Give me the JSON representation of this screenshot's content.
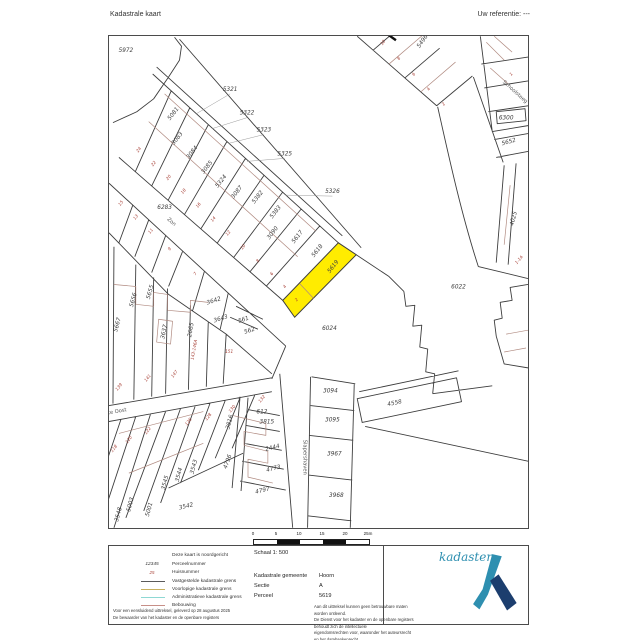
{
  "header": {
    "title": "Kadastrale kaart",
    "reference": "Uw referentie: ---"
  },
  "map": {
    "highlight_color": "#ffec00",
    "boundary_color": "#3d3d3d",
    "building_color": "#b08a80",
    "parcel_labels": [
      {
        "t": "5972",
        "x": 17,
        "y": 16,
        "s": 6.2
      },
      {
        "t": "5321",
        "x": 122,
        "y": 55,
        "s": 6
      },
      {
        "t": "5322",
        "x": 139,
        "y": 79,
        "s": 6
      },
      {
        "t": "5323",
        "x": 156,
        "y": 96,
        "s": 6
      },
      {
        "t": "5325",
        "x": 177,
        "y": 120,
        "s": 6
      },
      {
        "t": "5326",
        "x": 225,
        "y": 158,
        "s": 6
      },
      {
        "t": "6283",
        "x": 56,
        "y": 174,
        "s": 6
      },
      {
        "t": "5081",
        "x": 66,
        "y": 79,
        "r": -52
      },
      {
        "t": "3083",
        "x": 70,
        "y": 104,
        "r": -52
      },
      {
        "t": "3084",
        "x": 85,
        "y": 118,
        "r": -52
      },
      {
        "t": "3085",
        "x": 100,
        "y": 133,
        "r": -52
      },
      {
        "t": "5324",
        "x": 114,
        "y": 147,
        "r": -52
      },
      {
        "t": "3087",
        "x": 130,
        "y": 158,
        "r": -52
      },
      {
        "t": "5382",
        "x": 151,
        "y": 163,
        "r": -52
      },
      {
        "t": "5383",
        "x": 169,
        "y": 178,
        "r": -52
      },
      {
        "t": "3090",
        "x": 166,
        "y": 199,
        "r": -52
      },
      {
        "t": "5617",
        "x": 191,
        "y": 203,
        "r": -52
      },
      {
        "t": "5618",
        "x": 211,
        "y": 217,
        "r": -52
      },
      {
        "t": "5619",
        "x": 227,
        "y": 233,
        "r": -52
      },
      {
        "t": "5656",
        "x": 26,
        "y": 266,
        "r": -75
      },
      {
        "t": "5655",
        "x": 43,
        "y": 258,
        "r": -75
      },
      {
        "t": "5667",
        "x": 10,
        "y": 291,
        "r": -75
      },
      {
        "t": "3637",
        "x": 57,
        "y": 298,
        "r": -78
      },
      {
        "t": "2665",
        "x": 84,
        "y": 296,
        "r": -80
      },
      {
        "t": "3642",
        "x": 106,
        "y": 268,
        "r": -18
      },
      {
        "t": "3643",
        "x": 113,
        "y": 286,
        "r": -18
      },
      {
        "t": "561",
        "x": 136,
        "y": 287,
        "r": -18
      },
      {
        "t": "562",
        "x": 142,
        "y": 298,
        "r": -18
      },
      {
        "t": "6024",
        "x": 222,
        "y": 296,
        "s": 6.2
      },
      {
        "t": "6022",
        "x": 352,
        "y": 254,
        "s": 6.2
      },
      {
        "t": "4025",
        "x": 409,
        "y": 184,
        "r": -75
      },
      {
        "t": "6300",
        "x": 400,
        "y": 84
      },
      {
        "t": "5652",
        "x": 403,
        "y": 108,
        "r": -15
      },
      {
        "t": "5496",
        "x": 317,
        "y": 6,
        "r": -55
      },
      {
        "t": "3094",
        "x": 223,
        "y": 359
      },
      {
        "t": "3095",
        "x": 225,
        "y": 388
      },
      {
        "t": "3967",
        "x": 227,
        "y": 422
      },
      {
        "t": "3968",
        "x": 229,
        "y": 464
      },
      {
        "t": "4558",
        "x": 288,
        "y": 371,
        "r": -12
      },
      {
        "t": "612",
        "x": 154,
        "y": 380
      },
      {
        "t": "3815",
        "x": 159,
        "y": 390
      },
      {
        "t": "3816",
        "x": 123,
        "y": 389,
        "r": -75
      },
      {
        "t": "2444",
        "x": 165,
        "y": 416,
        "r": -14
      },
      {
        "t": "4773",
        "x": 166,
        "y": 437,
        "r": -14
      },
      {
        "t": "4797",
        "x": 155,
        "y": 459,
        "r": -14
      },
      {
        "t": "4796",
        "x": 121,
        "y": 429,
        "r": -70
      },
      {
        "t": "3548",
        "x": 11,
        "y": 482,
        "r": -75
      },
      {
        "t": "5003",
        "x": 23,
        "y": 472,
        "r": -75
      },
      {
        "t": "5001",
        "x": 42,
        "y": 477,
        "r": -75
      },
      {
        "t": "3545",
        "x": 58,
        "y": 450,
        "r": -75
      },
      {
        "t": "3544",
        "x": 72,
        "y": 442,
        "r": -75
      },
      {
        "t": "3543",
        "x": 87,
        "y": 434,
        "r": -75
      },
      {
        "t": "3542",
        "x": 78,
        "y": 475,
        "r": -14
      }
    ],
    "house_numbers": [
      {
        "t": "24",
        "x": 31,
        "y": 115,
        "r": -52
      },
      {
        "t": "22",
        "x": 46,
        "y": 129,
        "r": -52
      },
      {
        "t": "20",
        "x": 61,
        "y": 143,
        "r": -52
      },
      {
        "t": "18",
        "x": 76,
        "y": 157,
        "r": -52
      },
      {
        "t": "16",
        "x": 91,
        "y": 171,
        "r": -52
      },
      {
        "t": "14",
        "x": 106,
        "y": 185,
        "r": -52
      },
      {
        "t": "12",
        "x": 121,
        "y": 199,
        "r": -52
      },
      {
        "t": "10",
        "x": 136,
        "y": 213,
        "r": -52
      },
      {
        "t": "8",
        "x": 151,
        "y": 227,
        "r": -52
      },
      {
        "t": "6",
        "x": 165,
        "y": 240,
        "r": -52
      },
      {
        "t": "4",
        "x": 178,
        "y": 253,
        "r": -52
      },
      {
        "t": "2",
        "x": 190,
        "y": 266,
        "r": -52
      },
      {
        "t": "15",
        "x": 13,
        "y": 169,
        "r": -52
      },
      {
        "t": "13",
        "x": 28,
        "y": 183,
        "r": -52
      },
      {
        "t": "11",
        "x": 43,
        "y": 197,
        "r": -52
      },
      {
        "t": "9",
        "x": 62,
        "y": 215,
        "r": -52
      },
      {
        "t": "7",
        "x": 88,
        "y": 240,
        "r": -52
      },
      {
        "t": "143-146A",
        "x": 87,
        "y": 316,
        "r": -80
      },
      {
        "t": "151",
        "x": 121,
        "y": 319
      },
      {
        "t": "141",
        "x": 40,
        "y": 345,
        "r": -52
      },
      {
        "t": "139",
        "x": 11,
        "y": 354,
        "r": -52
      },
      {
        "t": "147",
        "x": 67,
        "y": 341,
        "r": -52
      },
      {
        "t": "118",
        "x": 6,
        "y": 416,
        "r": -52
      },
      {
        "t": "120",
        "x": 21,
        "y": 407,
        "r": -52
      },
      {
        "t": "122",
        "x": 40,
        "y": 398,
        "r": -52
      },
      {
        "t": "126",
        "x": 81,
        "y": 389,
        "r": -52
      },
      {
        "t": "128",
        "x": 101,
        "y": 384,
        "r": -52
      },
      {
        "t": "130",
        "x": 125,
        "y": 376,
        "r": -52
      },
      {
        "t": "132",
        "x": 155,
        "y": 366,
        "r": -52
      },
      {
        "t": "1",
        "x": 406,
        "y": 39,
        "r": -45
      },
      {
        "t": "1-1A",
        "x": 414,
        "y": 226,
        "r": -50
      },
      {
        "t": "10",
        "x": 277,
        "y": 7,
        "r": -55
      },
      {
        "t": "8",
        "x": 293,
        "y": 23,
        "r": -55
      },
      {
        "t": "6",
        "x": 308,
        "y": 39,
        "r": -55
      },
      {
        "t": "4",
        "x": 323,
        "y": 54,
        "r": -55
      },
      {
        "t": "2",
        "x": 338,
        "y": 69,
        "r": -55
      }
    ],
    "street_names": [
      {
        "t": "Zon",
        "x": 62,
        "y": 188,
        "r": 42
      },
      {
        "t": "Grote Oost",
        "x": 4,
        "y": 380,
        "r": -10
      },
      {
        "t": "Slapershaven",
        "x": 196,
        "y": 424,
        "r": 90
      },
      {
        "t": "Schoolsteeg",
        "x": 408,
        "y": 57,
        "r": 42
      }
    ]
  },
  "scalebar": {
    "labels": [
      "0",
      "5",
      "10",
      "15",
      "20",
      "25m"
    ]
  },
  "legend": {
    "items": [
      {
        "sample": "",
        "label": "Deze kaart is noordgericht",
        "color": ""
      },
      {
        "sample": "12345",
        "label": "Perceelnummer",
        "color": ""
      },
      {
        "sample": "25",
        "label": "Huisnummer",
        "color": ""
      },
      {
        "sample": "",
        "label": "Vastgestelde kadastrale grens",
        "color": "#5a5a5a"
      },
      {
        "sample": "",
        "label": "Voorlopige kadastrale grens",
        "color": "#c7b05f"
      },
      {
        "sample": "",
        "label": "Administratieve kadastrale grens",
        "color": "#8ed8d3"
      },
      {
        "sample": "",
        "label": "Bebouwing",
        "color": "#c78f88"
      }
    ]
  },
  "info": {
    "scale_label": "Schaal 1: 500",
    "rows": [
      {
        "label": "Kadastrale gemeente",
        "value": "Hoorn"
      },
      {
        "label": "Sectie",
        "value": "A"
      },
      {
        "label": "Perceel",
        "value": "5619"
      }
    ]
  },
  "fineprint": {
    "left1": "Voor een eensluidend uittreksel, geleverd op 28 augustus 2025",
    "left2": "De bewaarder van het kadaster en de openbare registers",
    "right1": "Aan dit uittreksel kunnen geen betrouwbare maten worden ontleend.",
    "right2": "De Dienst voor het kadaster en de openbare registers behoudt zich de intellectuele",
    "right3": "eigendomsrechten voor, waaronder het auteursrecht en het databankenrecht."
  },
  "logo": {
    "word": "kadaster",
    "teal": "#2e8fb0",
    "navy": "#1c3e6e"
  }
}
